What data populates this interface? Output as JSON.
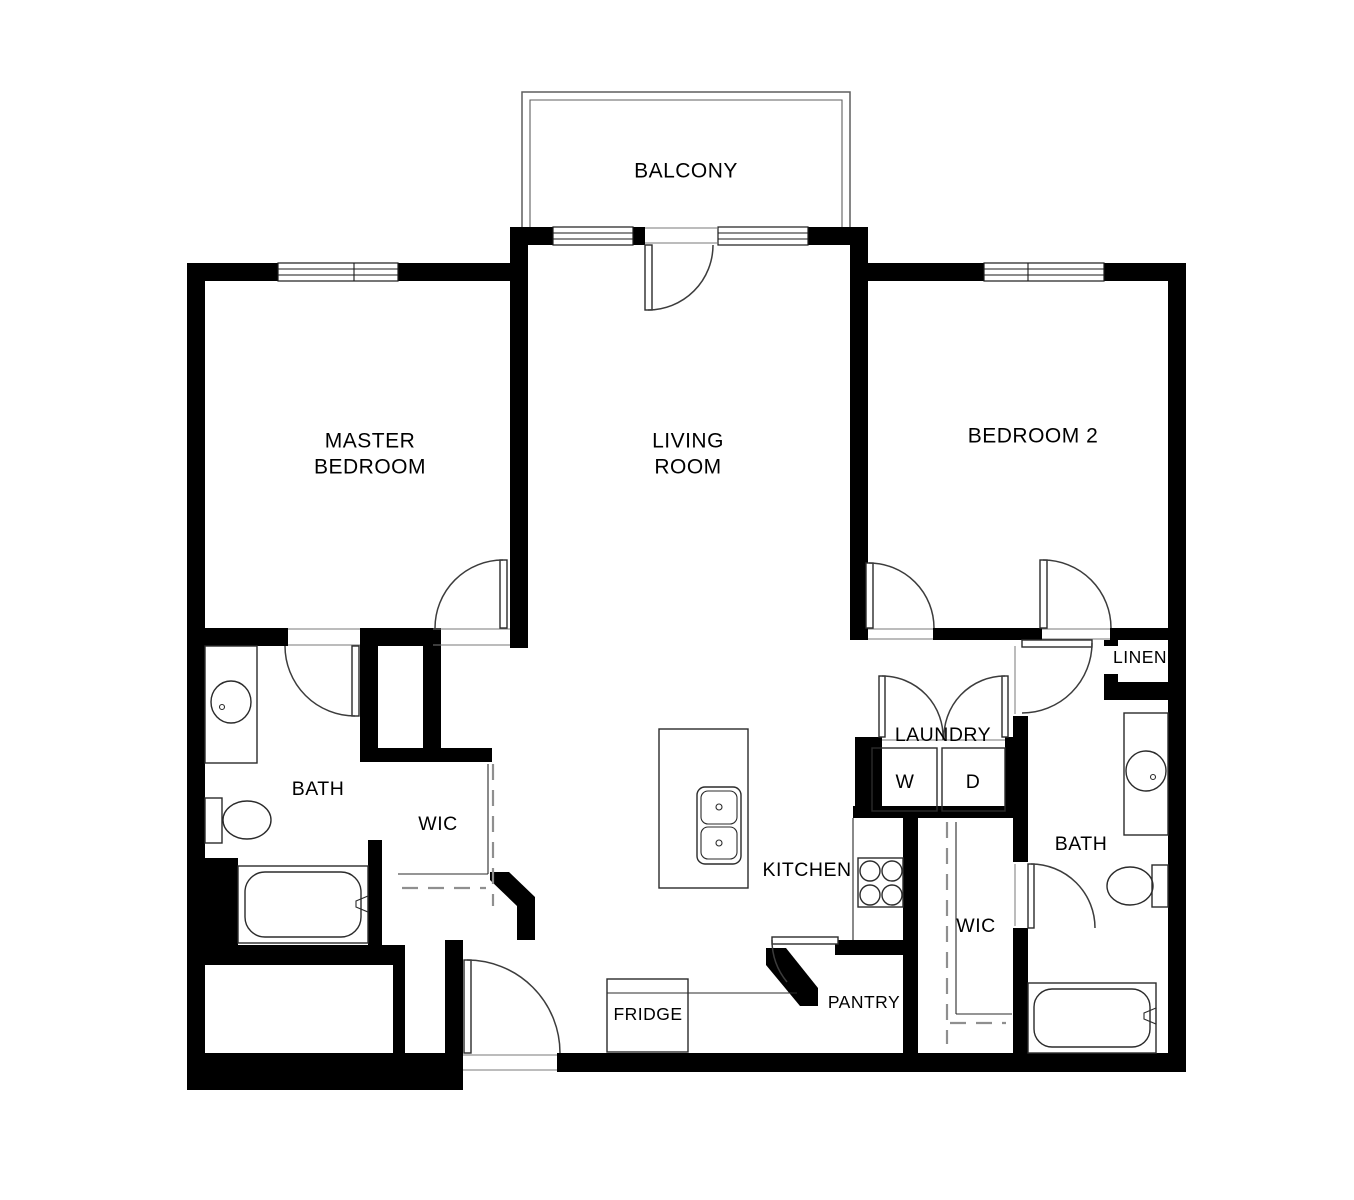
{
  "plan": {
    "labels": {
      "balcony": "BALCONY",
      "master_bedroom_l1": "MASTER",
      "master_bedroom_l2": "BEDROOM",
      "living_room_l1": "LIVING",
      "living_room_l2": "ROOM",
      "bedroom2": "BEDROOM 2",
      "bath_master": "BATH",
      "wic_master": "WIC",
      "laundry": "LAUNDRY",
      "washer": "W",
      "dryer": "D",
      "kitchen": "KITCHEN",
      "wic_bedroom2": "WIC",
      "bath_bedroom2": "BATH",
      "linen": "LINEN",
      "fridge": "FRIDGE",
      "pantry": "PANTRY"
    },
    "colors": {
      "background": "#ffffff",
      "wall": "#000000",
      "fixture_line": "#2b2b2b",
      "dashed_line": "#8f8f8f",
      "door_arc": "#3c3c3c",
      "balcony_line": "#5f5f5f",
      "text": "#000000"
    }
  }
}
